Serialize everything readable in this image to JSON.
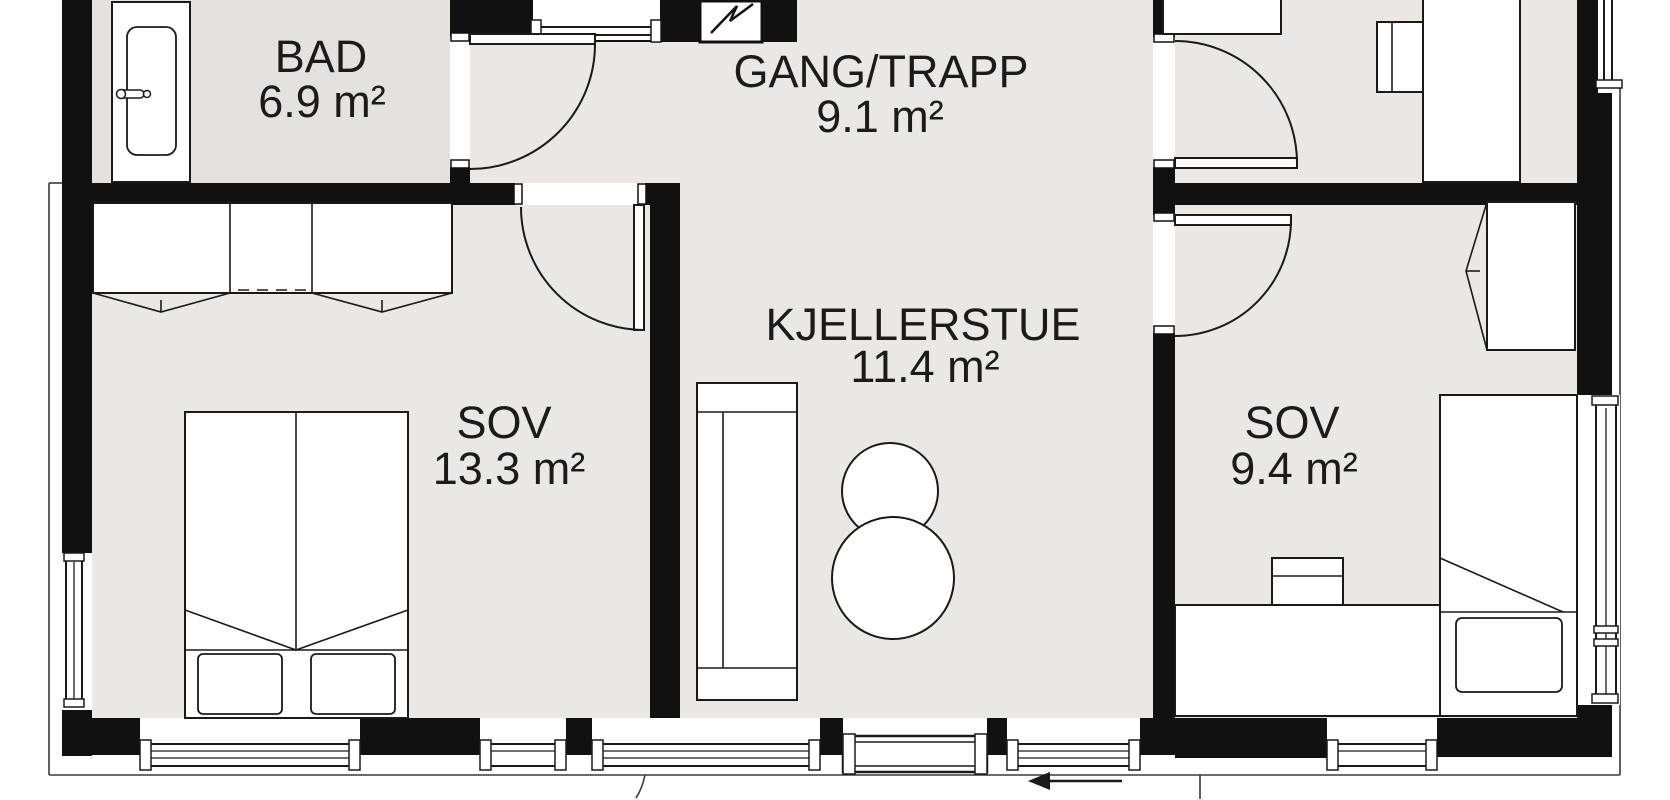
{
  "plan": {
    "type": "floor-plan",
    "rooms": [
      {
        "id": "bad",
        "name": "BAD",
        "area": "6.9 m²"
      },
      {
        "id": "gang-trapp",
        "name": "GANG/TRAPP",
        "area": "9.1 m²"
      },
      {
        "id": "kjellerstue",
        "name": "KJELLERSTUE",
        "area": "11.4 m²"
      },
      {
        "id": "sov-1",
        "name": "SOV",
        "area": "13.3 m²"
      },
      {
        "id": "sov-2",
        "name": "SOV",
        "area": "9.4 m²"
      }
    ],
    "fixtures": [
      "bathtub",
      "wardrobe",
      "double-bed",
      "pillows",
      "sofa",
      "round-tables",
      "desk",
      "chair",
      "single-bed",
      "nightstand-pillow"
    ],
    "icons": [
      {
        "name": "fuse-box-icon",
        "meaning": "electrical cabinet symbol (zigzag)"
      },
      {
        "name": "entrance-arrow-icon",
        "meaning": "entry direction arrow pointing left"
      }
    ],
    "colors": {
      "wall": "#111111",
      "floor": "#eae8e4",
      "bad_floor": "#e3e2de",
      "line": "#1a1a1a",
      "background": "#ffffff"
    }
  }
}
